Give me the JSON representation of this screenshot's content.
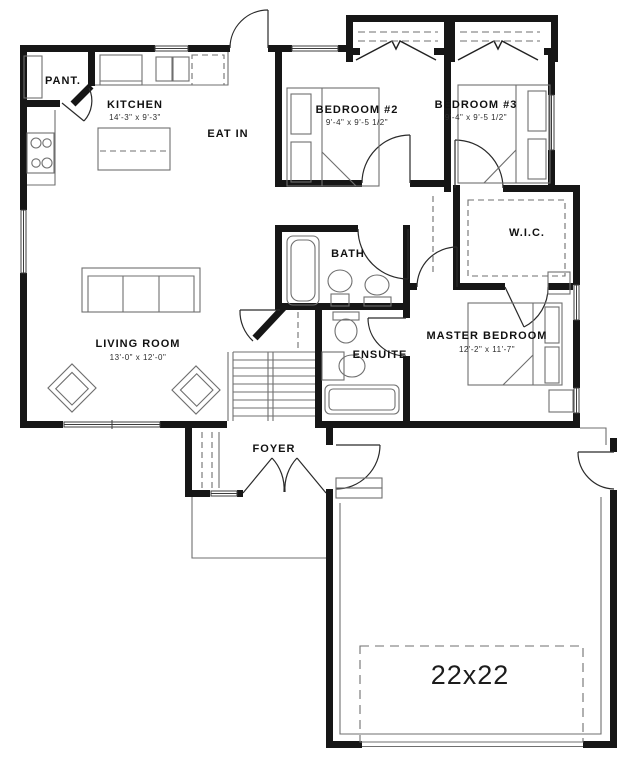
{
  "plan": {
    "rooms": {
      "pantry": {
        "label": "PANT."
      },
      "kitchen": {
        "label": "KITCHEN",
        "dims": "14'-3\" x 9'-3\""
      },
      "eat_in": {
        "label": "EAT IN"
      },
      "bedroom2": {
        "label": "BEDROOM #2",
        "dims": "9'-4\" x 9'-5 1/2\""
      },
      "bedroom3": {
        "label": "BEDROOM #3",
        "dims": "9'-4\" x 9'-5 1/2\""
      },
      "bath": {
        "label": "BATH"
      },
      "wic": {
        "label": "W.I.C."
      },
      "living_room": {
        "label": "LIVING ROOM",
        "dims": "13'-0\" x 12'-0\""
      },
      "master_bedroom": {
        "label": "MASTER BEDROOM",
        "dims": "12'-2\" x 11'-7\""
      },
      "ensuite": {
        "label": "ENSUITE"
      },
      "foyer": {
        "label": "FOYER"
      },
      "garage": {
        "label": "22x22"
      }
    },
    "colors": {
      "wall": "#161616",
      "line": "#6f6f6f",
      "text": "#111111",
      "background": "#ffffff"
    }
  }
}
